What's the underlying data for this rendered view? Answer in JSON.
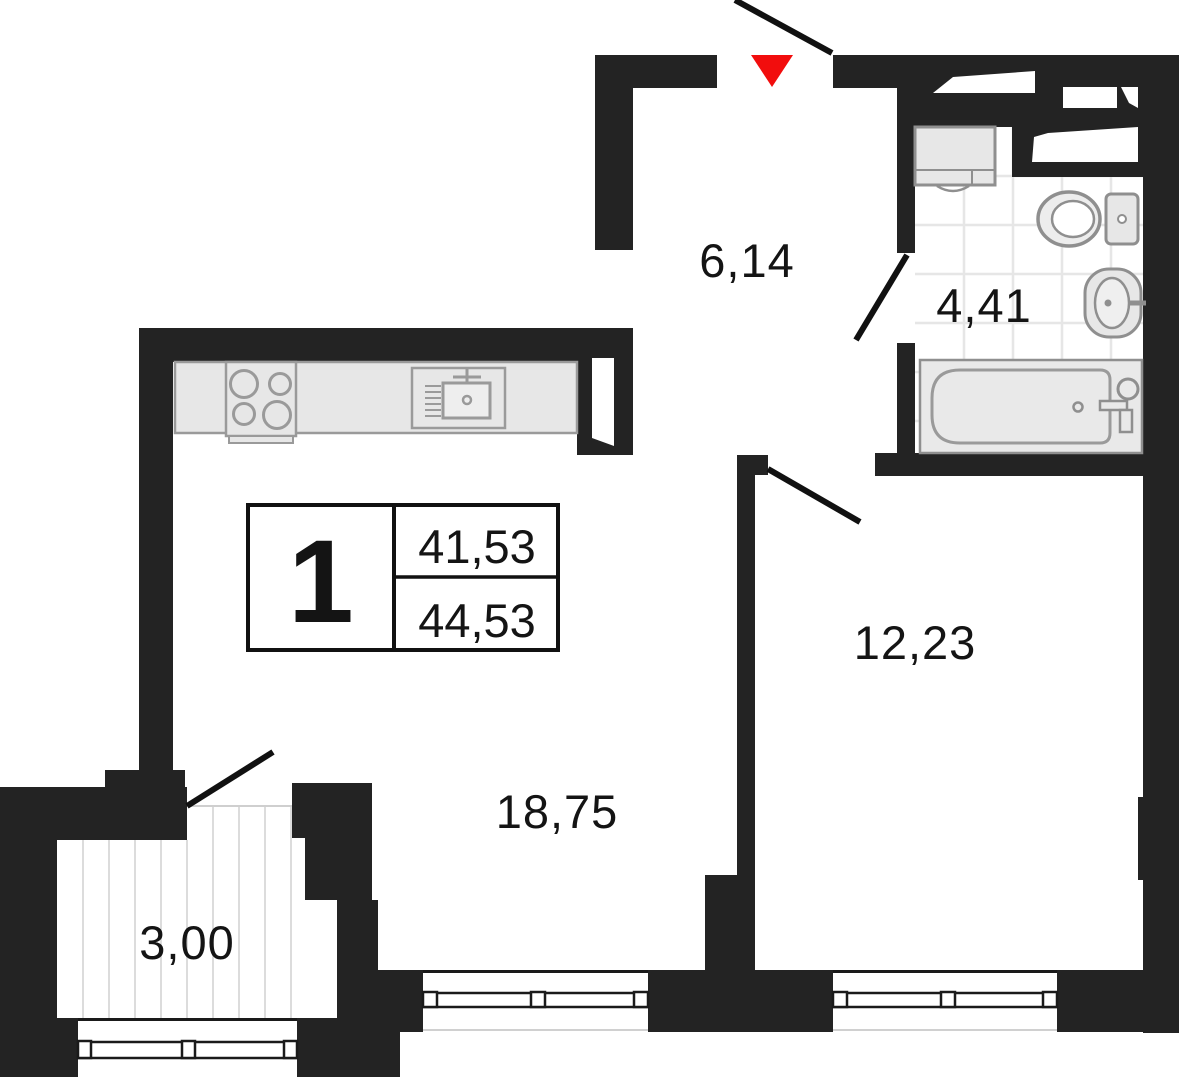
{
  "title": "Apartment floor plan, 1-room",
  "legend": {
    "rooms_count": "1",
    "area_living": "41,53",
    "area_total": "44,53"
  },
  "rooms": {
    "hallway": {
      "label": "6,14"
    },
    "bathroom": {
      "label": "4,41"
    },
    "bedroom": {
      "label": "12,23"
    },
    "living": {
      "label": "18,75"
    },
    "balcony": {
      "label": "3,00"
    }
  },
  "colors": {
    "wall": "#232323",
    "marker_red": "#f20d0d",
    "legend_number_red": "#f20d0d",
    "fixture_fill": "#e7e7e7",
    "fixture_stroke": "#8f8f8f",
    "tile_line": "#e6e6e6",
    "stripe_line": "#dcdcdc",
    "text": "#141414"
  }
}
